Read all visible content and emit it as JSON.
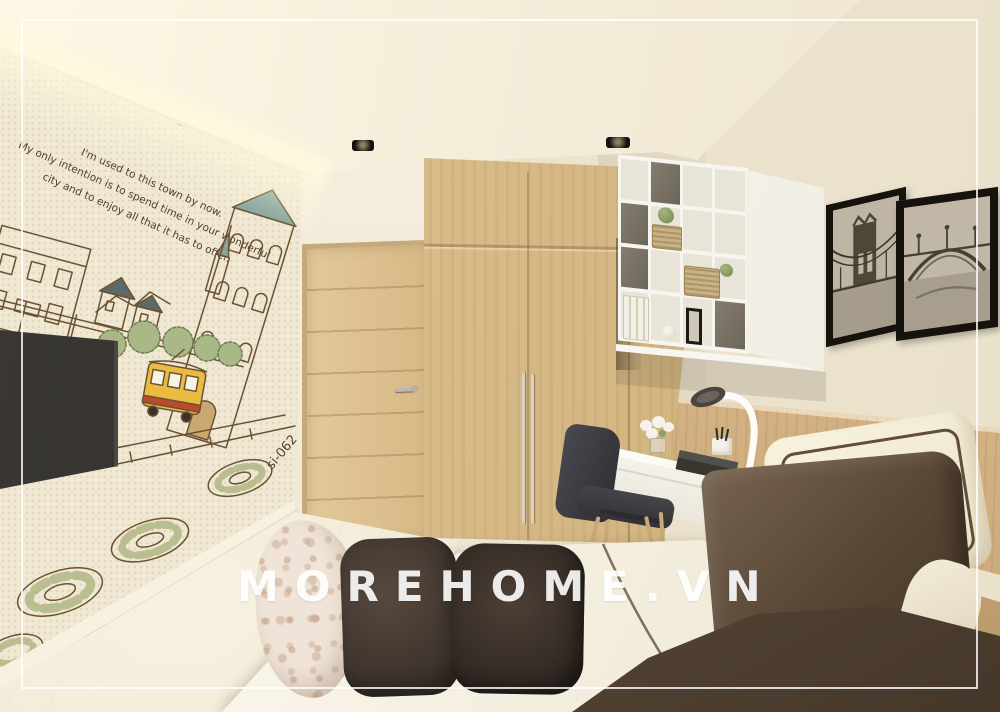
{
  "watermark": {
    "text": "MOREHOME.VN"
  },
  "mural": {
    "title": "city background",
    "caption_line1": "I'm used to this town by now.",
    "caption_line2": "My only intention is to spend time in your wonderful",
    "caption_line3": "city and to enjoy all that it has to offer.",
    "sticker_code": "si-062"
  },
  "palette": {
    "wallBeige": "#ece3cf",
    "ceiling": "#f4edda",
    "muralPaper": "#f0e8d3",
    "muralInk": "#63492c",
    "muralGreen": "#a9b886",
    "tramYellow": "#e9bc41",
    "tramStripe": "#bc4a2e",
    "spireTeal": "#87a49e",
    "woodDoor": "#d6b986",
    "woodHeadboard": "#ddbf92",
    "woodFloor": "#ece4d3",
    "tvBlack": "#2a2826",
    "shelfWhite": "#f7f5ef",
    "basketTan": "#c8b184",
    "deskWhite": "#e9e5d9",
    "chairBlack": "#2f2e34",
    "legWood": "#c8a977",
    "sheetWhite": "#f1ebda",
    "pillowFloral": "#efe4d7",
    "pillowDark1": "#3a312a",
    "pillowDark2": "#2f2722",
    "pillowBrown": "#594736",
    "pillowCream": "#e9e1c8",
    "blanketBrown": "#5a4a3c",
    "frameBlack": "#16130e",
    "watermark": "#ffffff"
  }
}
